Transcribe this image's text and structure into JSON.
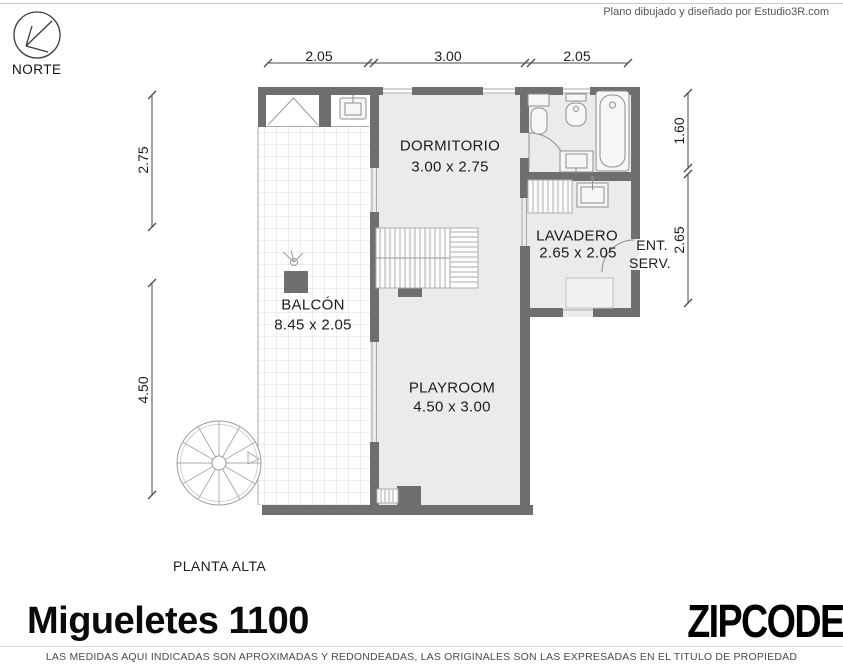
{
  "credit": "Plano dibujado y diseñado por Estudio3R.com",
  "north": {
    "label": "NORTE"
  },
  "dimensions": {
    "top": [
      "2.05",
      "3.00",
      "2.05"
    ],
    "left": [
      "2.75",
      "4.50"
    ],
    "right": [
      "1.60",
      "2.65"
    ]
  },
  "rooms": {
    "dormitorio": {
      "name": "DORMITORIO",
      "size": "3.00 x 2.75"
    },
    "lavadero": {
      "name": "LAVADERO",
      "size": "2.65 x 2.05"
    },
    "balcon": {
      "name": "BALCÓN",
      "size": "8.45 x 2.05"
    },
    "playroom": {
      "name": "PLAYROOM",
      "size": "4.50 x 3.00"
    }
  },
  "labels": {
    "service_entrance": [
      "ENT.",
      "SERV."
    ],
    "floor": "PLANTA ALTA"
  },
  "footer": {
    "address": "Migueletes 1100",
    "brand": "ZIPCODE",
    "disclaimer": "LAS MEDIDAS AQUI INDICADAS SON APROXIMADAS Y REDONDEADAS, LAS ORIGINALES SON LAS EXPRESADAS EN EL TITULO DE PROPIEDAD"
  },
  "colors": {
    "wall": "#6f6f6f",
    "floor": "#ebebeb",
    "tile_line": "#dcdcdc",
    "fixture_line": "#8f8f8f",
    "text": "#1c1c1c"
  }
}
